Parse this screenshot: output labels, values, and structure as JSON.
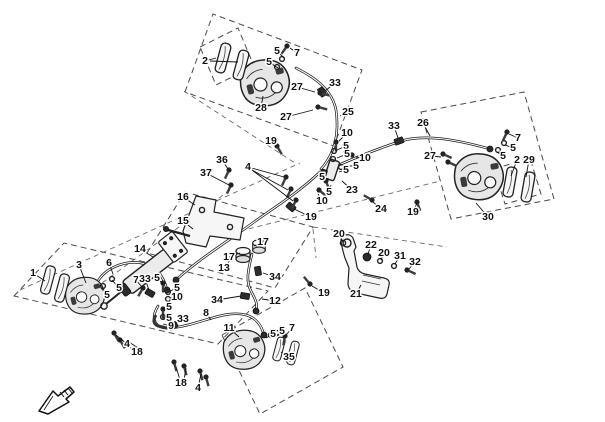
{
  "canvas": {
    "width": 605,
    "height": 422,
    "background": "#ffffff"
  },
  "styles": {
    "line_color": "#1a1a1a",
    "panel_dash_color": "#4a4a4a",
    "label_color": "#111111",
    "label_font_size": 10.5
  },
  "diagram": {
    "type": "exploded-parts-diagram",
    "subject": "brake system (calipers, pads, master cylinder, hoses, pedal)",
    "unique_part_numbers": [
      "1",
      "2",
      "3",
      "4",
      "5",
      "6",
      "7",
      "8",
      "9",
      "10",
      "11",
      "12",
      "13",
      "14",
      "15",
      "16",
      "17",
      "18",
      "19",
      "20",
      "21",
      "22",
      "23",
      "24",
      "25",
      "26",
      "27",
      "28",
      "29",
      "30",
      "31",
      "32",
      "33",
      "34",
      "35",
      "36",
      "37"
    ]
  },
  "direction_icon": {
    "name": "front-direction-arrow",
    "x": 36,
    "y": 384
  },
  "callouts": [
    {
      "label": "1",
      "x": 33,
      "y": 273,
      "tx": 45,
      "ty": 281
    },
    {
      "label": "3",
      "x": 79,
      "y": 265,
      "tx": 86,
      "ty": 283
    },
    {
      "label": "6",
      "x": 109,
      "y": 263,
      "tx": 113,
      "ty": 274
    },
    {
      "label": "2",
      "x": 205,
      "y": 61,
      "tx": 216,
      "ty": 58
    },
    {
      "label": "5",
      "x": 277,
      "y": 51,
      "tx": 284,
      "ty": 58
    },
    {
      "label": "7",
      "x": 297,
      "y": 53,
      "tx": 290,
      "ty": 48
    },
    {
      "label": "5",
      "x": 269,
      "y": 62,
      "tx": 278,
      "ty": 68
    },
    {
      "label": "27",
      "x": 297,
      "y": 87,
      "tx": 315,
      "ty": 92
    },
    {
      "label": "28",
      "x": 261,
      "y": 108,
      "tx": 263,
      "ty": 96
    },
    {
      "label": "27",
      "x": 286,
      "y": 117,
      "tx": 313,
      "ty": 110
    },
    {
      "label": "33",
      "x": 335,
      "y": 83,
      "tx": 325,
      "ty": 91
    },
    {
      "label": "25",
      "x": 348,
      "y": 112,
      "tx": 340,
      "ty": 116
    },
    {
      "label": "19",
      "x": 271,
      "y": 141,
      "tx": 277,
      "ty": 146
    },
    {
      "label": "10",
      "x": 347,
      "y": 133,
      "tx": 339,
      "ty": 141
    },
    {
      "label": "5",
      "x": 346,
      "y": 146,
      "tx": 337,
      "ty": 150
    },
    {
      "label": "5",
      "x": 347,
      "y": 154,
      "tx": 337,
      "ty": 158
    },
    {
      "label": "10",
      "x": 365,
      "y": 158,
      "tx": 356,
      "ty": 157
    },
    {
      "label": "5",
      "x": 356,
      "y": 166,
      "tx": 347,
      "ty": 166
    },
    {
      "label": "5",
      "x": 346,
      "y": 170,
      "tx": 339,
      "ty": 172
    },
    {
      "label": "5",
      "x": 322,
      "y": 177,
      "tx": 329,
      "ty": 179
    },
    {
      "label": "5",
      "x": 329,
      "y": 192,
      "tx": 331,
      "ty": 185
    },
    {
      "label": "23",
      "x": 352,
      "y": 190,
      "tx": 342,
      "ty": 181
    },
    {
      "label": "10",
      "x": 322,
      "y": 201,
      "tx": 318,
      "ty": 194
    },
    {
      "label": "24",
      "x": 381,
      "y": 209,
      "tx": 373,
      "ty": 202
    },
    {
      "label": "19",
      "x": 413,
      "y": 212,
      "tx": 417,
      "ty": 203
    },
    {
      "label": "33",
      "x": 394,
      "y": 126,
      "tx": 398,
      "ty": 138
    },
    {
      "label": "26",
      "x": 423,
      "y": 123,
      "tx": 430,
      "ty": 136
    },
    {
      "label": "27",
      "x": 430,
      "y": 156,
      "tx": 441,
      "ty": 157
    },
    {
      "label": "7",
      "x": 518,
      "y": 138,
      "tx": 509,
      "ty": 134
    },
    {
      "label": "5",
      "x": 513,
      "y": 148,
      "tx": 505,
      "ty": 145
    },
    {
      "label": "5",
      "x": 503,
      "y": 156,
      "tx": 497,
      "ty": 152
    },
    {
      "label": "2",
      "x": 517,
      "y": 160,
      "tx": 511,
      "ty": 176
    },
    {
      "label": "29",
      "x": 529,
      "y": 160,
      "tx": 526,
      "ty": 177
    },
    {
      "label": "30",
      "x": 488,
      "y": 217,
      "tx": 476,
      "ty": 203
    },
    {
      "label": "36",
      "x": 222,
      "y": 160,
      "tx": 228,
      "ty": 169
    },
    {
      "label": "37",
      "x": 206,
      "y": 173,
      "tx": 229,
      "ty": 185
    },
    {
      "label": "4",
      "x": 248,
      "y": 167,
      "tx": 284,
      "ty": 177
    },
    {
      "label": "16",
      "x": 183,
      "y": 197,
      "tx": 195,
      "ty": 205
    },
    {
      "label": "15",
      "x": 183,
      "y": 221,
      "tx": 193,
      "ty": 229
    },
    {
      "label": "14",
      "x": 140,
      "y": 249,
      "tx": 153,
      "ty": 257
    },
    {
      "label": "13",
      "x": 224,
      "y": 268,
      "tx": 231,
      "ty": 259
    },
    {
      "label": "17",
      "x": 263,
      "y": 242,
      "tx": 254,
      "ty": 246
    },
    {
      "label": "17",
      "x": 229,
      "y": 257,
      "tx": 240,
      "ty": 253
    },
    {
      "label": "34",
      "x": 275,
      "y": 277,
      "tx": 263,
      "ty": 273
    },
    {
      "label": "34",
      "x": 217,
      "y": 300,
      "tx": 241,
      "ty": 296
    },
    {
      "label": "12",
      "x": 275,
      "y": 301,
      "tx": 262,
      "ty": 299
    },
    {
      "label": "19",
      "x": 324,
      "y": 293,
      "tx": 312,
      "ty": 286
    },
    {
      "label": "20",
      "x": 339,
      "y": 234,
      "tx": 343,
      "ty": 242
    },
    {
      "label": "22",
      "x": 371,
      "y": 245,
      "tx": 368,
      "ty": 254
    },
    {
      "label": "20",
      "x": 384,
      "y": 253,
      "tx": 381,
      "ty": 260
    },
    {
      "label": "31",
      "x": 400,
      "y": 256,
      "tx": 395,
      "ty": 264
    },
    {
      "label": "32",
      "x": 415,
      "y": 262,
      "tx": 409,
      "ty": 269
    },
    {
      "label": "21",
      "x": 356,
      "y": 294,
      "tx": 361,
      "ty": 285
    },
    {
      "label": "7",
      "x": 136,
      "y": 280,
      "tx": 142,
      "ty": 287
    },
    {
      "label": "33",
      "x": 145,
      "y": 279,
      "tx": 149,
      "ty": 290
    },
    {
      "label": "5",
      "x": 119,
      "y": 288,
      "tx": 112,
      "ty": 280
    },
    {
      "label": "5",
      "x": 107,
      "y": 295,
      "tx": 101,
      "ty": 288
    },
    {
      "label": "5",
      "x": 157,
      "y": 278,
      "tx": 163,
      "ty": 284
    },
    {
      "label": "5",
      "x": 177,
      "y": 288,
      "tx": 170,
      "ty": 291
    },
    {
      "label": "10",
      "x": 177,
      "y": 297,
      "tx": 170,
      "ty": 298
    },
    {
      "label": "5",
      "x": 169,
      "y": 307,
      "tx": 163,
      "ty": 309
    },
    {
      "label": "5",
      "x": 169,
      "y": 318,
      "tx": 163,
      "ty": 317
    },
    {
      "label": "9",
      "x": 171,
      "y": 326,
      "tx": 163,
      "ty": 324
    },
    {
      "label": "33",
      "x": 183,
      "y": 319,
      "tx": 175,
      "ty": 324
    },
    {
      "label": "8",
      "x": 206,
      "y": 313,
      "tx": 211,
      "ty": 320
    },
    {
      "label": "4",
      "x": 127,
      "y": 344,
      "tx": 116,
      "ty": 335
    },
    {
      "label": "18",
      "x": 137,
      "y": 352,
      "tx": 123,
      "ty": 343
    },
    {
      "label": "18",
      "x": 181,
      "y": 383,
      "tx": 176,
      "ty": 367
    },
    {
      "label": "4",
      "x": 198,
      "y": 388,
      "tx": 201,
      "ty": 374
    },
    {
      "label": "11",
      "x": 229,
      "y": 328,
      "tx": 239,
      "ty": 337
    },
    {
      "label": "5",
      "x": 273,
      "y": 334,
      "tx": 266,
      "ty": 338
    },
    {
      "label": "5",
      "x": 282,
      "y": 331,
      "tx": 276,
      "ty": 336
    },
    {
      "label": "7",
      "x": 292,
      "y": 328,
      "tx": 286,
      "ty": 335
    },
    {
      "label": "35",
      "x": 289,
      "y": 357,
      "tx": 281,
      "ty": 352
    },
    {
      "label": "19",
      "x": 311,
      "y": 217,
      "tx": 294,
      "ty": 209
    }
  ]
}
